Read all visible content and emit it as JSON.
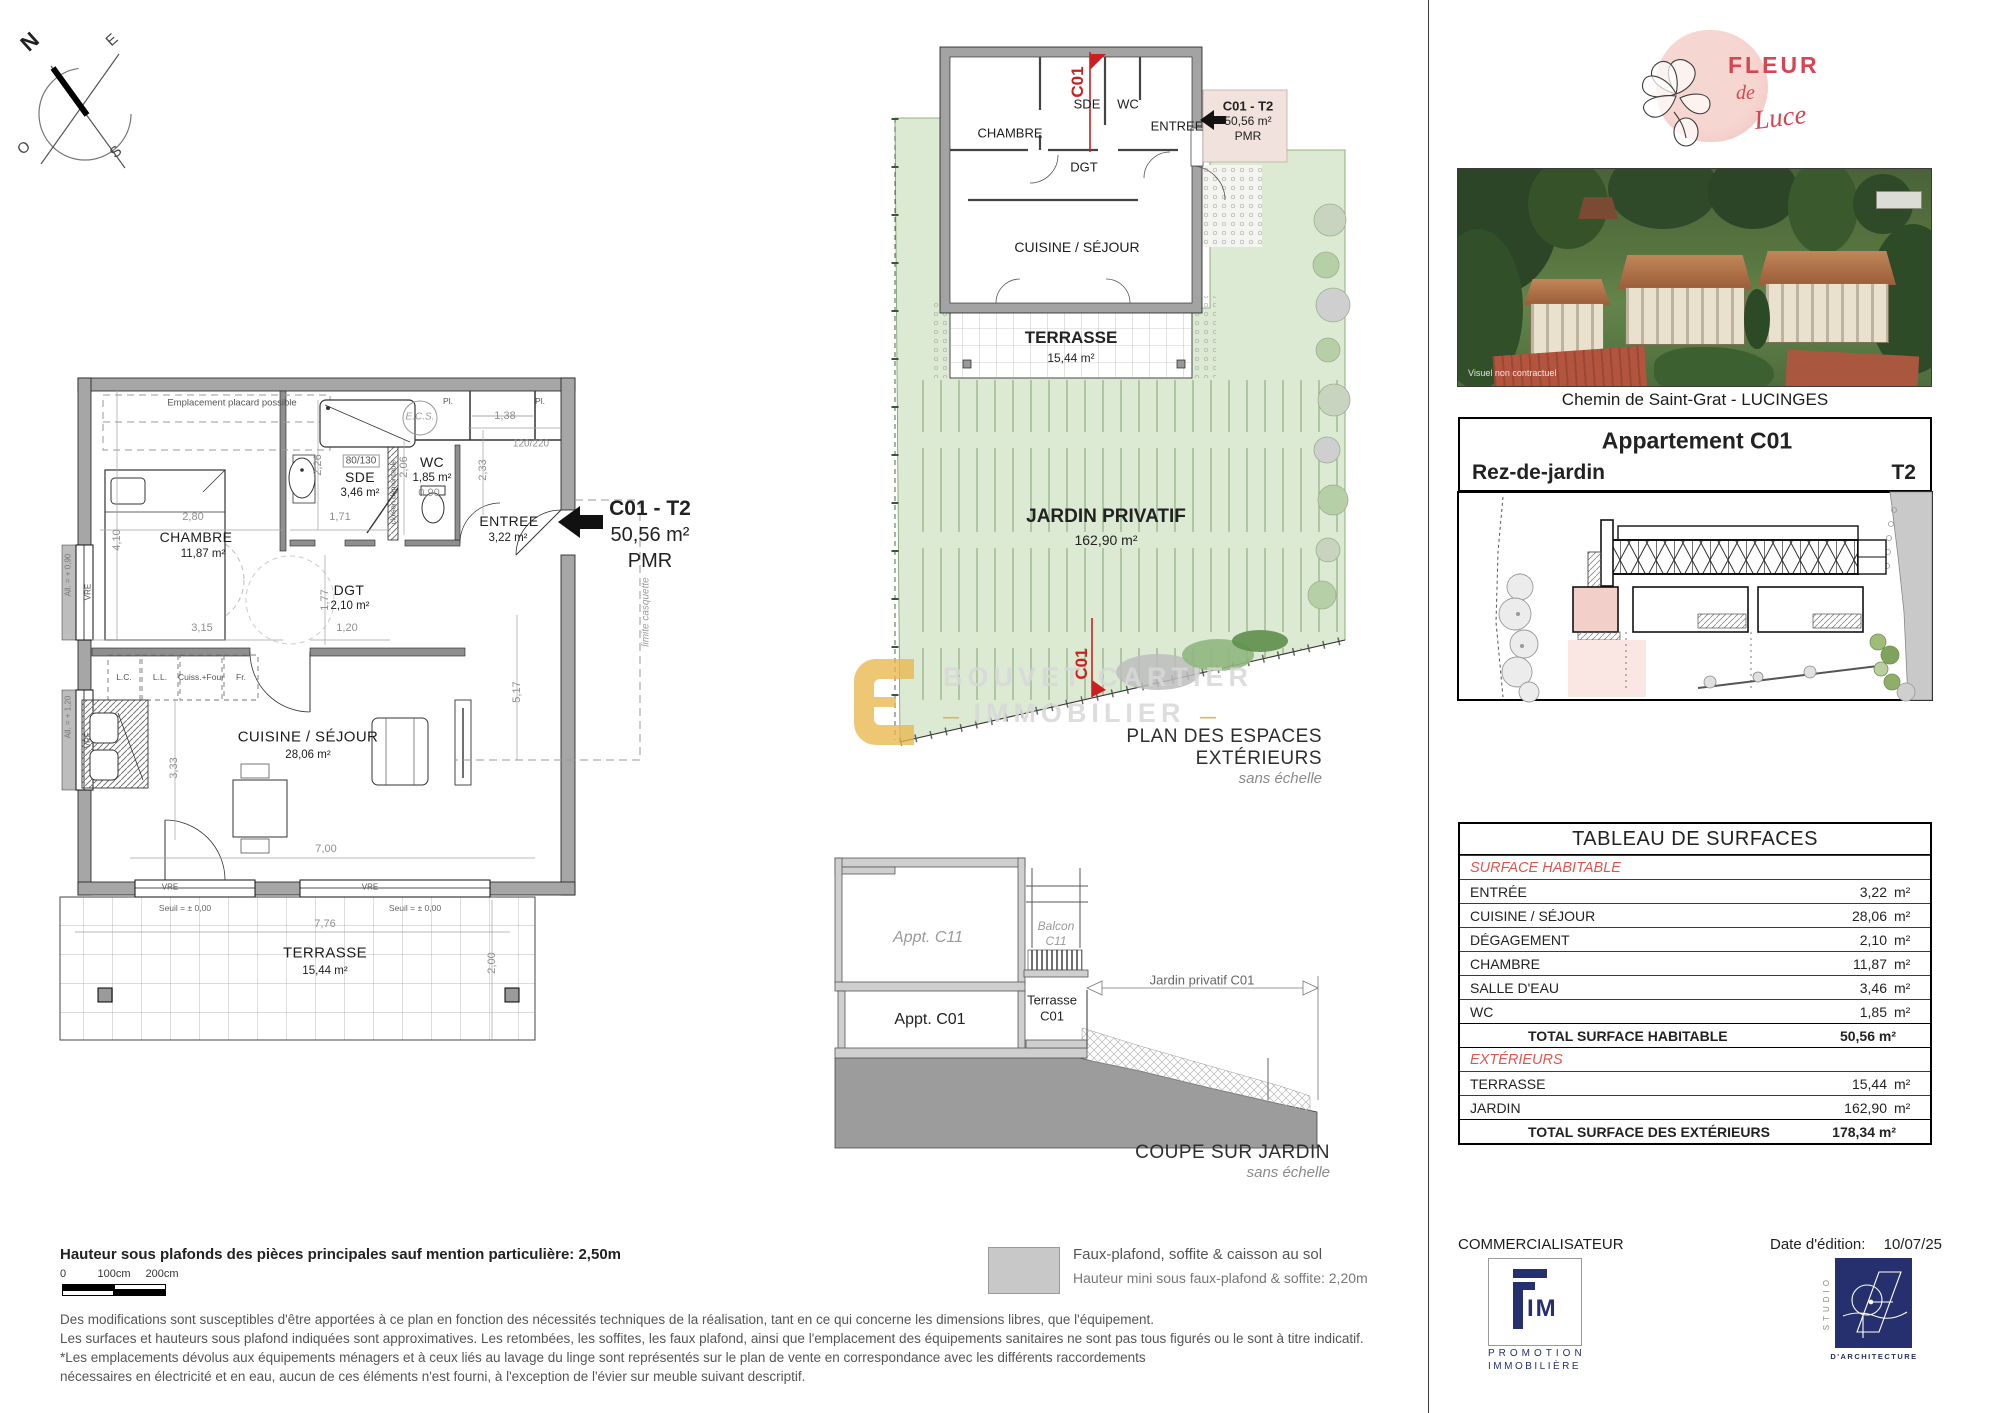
{
  "colors": {
    "wall_gray": "#a6a6a6",
    "garden_green": "#dcead3",
    "accent_red": "#e0564e",
    "cut_red": "#cc1f1f",
    "navy": "#27306e",
    "brand_pink": "#f3cbc6",
    "brand_red": "#d64553",
    "watermark_gold": "#e9b64b",
    "highlight_pink": "#f4ddd8"
  },
  "compass": {
    "n": "N",
    "e": "E",
    "s": "S",
    "o": "O"
  },
  "main_plan": {
    "note_placard": "Emplacement placard possible",
    "chambre": "CHAMBRE",
    "chambre_area": "11,87 m²",
    "sde": "SDE",
    "sde_area": "3,46 m²",
    "sde_size": "80/130",
    "wc": "WC",
    "wc_area": "1,85 m²",
    "entree": "ENTREE",
    "entree_area": "3,22 m²",
    "dgt": "DGT",
    "dgt_area": "2,10 m²",
    "cuisine": "CUISINE / SÉJOUR",
    "cuisine_area": "28,06 m²",
    "terrasse": "TERRASSE",
    "terrasse_area": "15,44 m²",
    "ecs": "E.C.S.",
    "pl": "Pl.",
    "lc": "L.C.",
    "ll": "L.L.",
    "cuiss": "Cuiss.+Four",
    "fr": "Fr.",
    "vre": "VRE",
    "seuil": "Seuil = ± 0,00",
    "limite": "limite casquette",
    "cloison": "cloison démontable",
    "all_090": "All. = + 0,90",
    "all_120": "All. = + 1,20",
    "tag_code": "C01 - T2",
    "tag_area": "50,56 m²",
    "tag_pmr": "PMR",
    "d_280": "2,80",
    "d_410": "4,10",
    "d_315": "3,15",
    "d_171": "1,71",
    "d_120": "1,20",
    "d_177": "1,77",
    "d_226": "2,26",
    "d_233": "2,33",
    "d_138": "1,38",
    "d_090": "0,90",
    "d_206": "2,06",
    "d_517": "5,17",
    "d_333": "3,33",
    "d_700": "7,00",
    "d_776": "7,76",
    "d_200": "2,00",
    "d_120220": "120/220"
  },
  "site_plan": {
    "title": "PLAN DES ESPACES EXTÉRIEURS",
    "subtitle": "sans échelle",
    "cut": "C01",
    "chambre": "CHAMBRE",
    "sde": "SDE",
    "wc": "WC",
    "entree": "ENTREE",
    "dgt": "DGT",
    "cuisine": "CUISINE / SÉJOUR",
    "terrasse": "TERRASSE",
    "terrasse_area": "15,44 m²",
    "jardin": "JARDIN PRIVATIF",
    "jardin_area": "162,90 m²",
    "tag_code": "C01 - T2",
    "tag_area": "50,56 m²",
    "tag_pmr": "PMR"
  },
  "watermark": {
    "line1": "BOUVET CARTIER",
    "line2": "IMMOBILIER",
    "dash": "—"
  },
  "section": {
    "appt_c11": "Appt. C11",
    "balcon_l1": "Balcon",
    "balcon_l2": "C11",
    "appt_c01": "Appt. C01",
    "terrasse_l1": "Terrasse",
    "terrasse_l2": "C01",
    "jardin_dim": "Jardin privatif C01",
    "title": "COUPE SUR JARDIN",
    "subtitle": "sans échelle"
  },
  "brand": {
    "fleur": "FLEUR",
    "de": "de",
    "luce": "Luce"
  },
  "photo": {
    "note": "Visuel non contractuel"
  },
  "sidebar": {
    "address": "Chemin de Saint-Grat - LUCINGES",
    "apt_title": "Appartement C01",
    "level": "Rez-de-jardin",
    "type": "T2"
  },
  "surfaces": {
    "title": "TABLEAU DE SURFACES",
    "sec1": "SURFACE HABITABLE",
    "sec2": "EXTÉRIEURS",
    "rows": [
      {
        "l": "ENTRÉE",
        "v": "3,22",
        "u": "m²"
      },
      {
        "l": "CUISINE / SÉJOUR",
        "v": "28,06",
        "u": "m²"
      },
      {
        "l": "DÉGAGEMENT",
        "v": "2,10",
        "u": "m²"
      },
      {
        "l": "CHAMBRE",
        "v": "11,87",
        "u": "m²"
      },
      {
        "l": "SALLE D'EAU",
        "v": "3,46",
        "u": "m²"
      },
      {
        "l": "WC",
        "v": "1,85",
        "u": "m²"
      }
    ],
    "total1_l": "TOTAL SURFACE HABITABLE",
    "total1_v": "50,56 m²",
    "ext_rows": [
      {
        "l": "TERRASSE",
        "v": "15,44",
        "u": "m²"
      },
      {
        "l": "JARDIN",
        "v": "162,90",
        "u": "m²"
      }
    ],
    "total2_l": "TOTAL SURFACE DES EXTÉRIEURS",
    "total2_v": "178,34 m²"
  },
  "footer": {
    "height_note": "Hauteur sous plafonds des pièces principales sauf mention particulière: 2,50m",
    "scale0": "0",
    "scale100": "100cm",
    "scale200": "200cm",
    "legend1": "Faux-plafond, soffite & caisson au sol",
    "legend2": "Hauteur mini sous faux-plafond & soffite: 2,20m",
    "disc1": "Des modifications sont susceptibles d'être apportées à ce plan en fonction des nécessités techniques de la réalisation, tant en ce qui concerne les dimensions libres, que l'équipement.",
    "disc2": "Les surfaces et hauteurs sous plafond indiquées sont approximatives. Les retombées, les soffites, les faux plafond, ainsi que l'emplacement des équipements sanitaires ne sont pas tous figurés ou le sont à titre indicatif.",
    "disc3": "*Les emplacements dévolus aux équipements ménagers et à ceux liés au lavage du linge sont représentés sur le plan de vente en correspondance avec les différents raccordements",
    "disc4": "nécessaires en électricité et en eau, aucun de ces éléments n'est fourni, à l'exception de l'évier sur meuble suivant descriptif.",
    "commercialisateur": "COMMERCIALISATEUR",
    "fim_im": "IM",
    "fim_l1": "PROMOTION",
    "fim_l2": "IMMOBILIÈRE",
    "date_label": "Date d'édition:",
    "date_value": "10/07/25",
    "studio_side": "STUDIO",
    "studio_bottom": "D'ARCHITECTURE"
  }
}
